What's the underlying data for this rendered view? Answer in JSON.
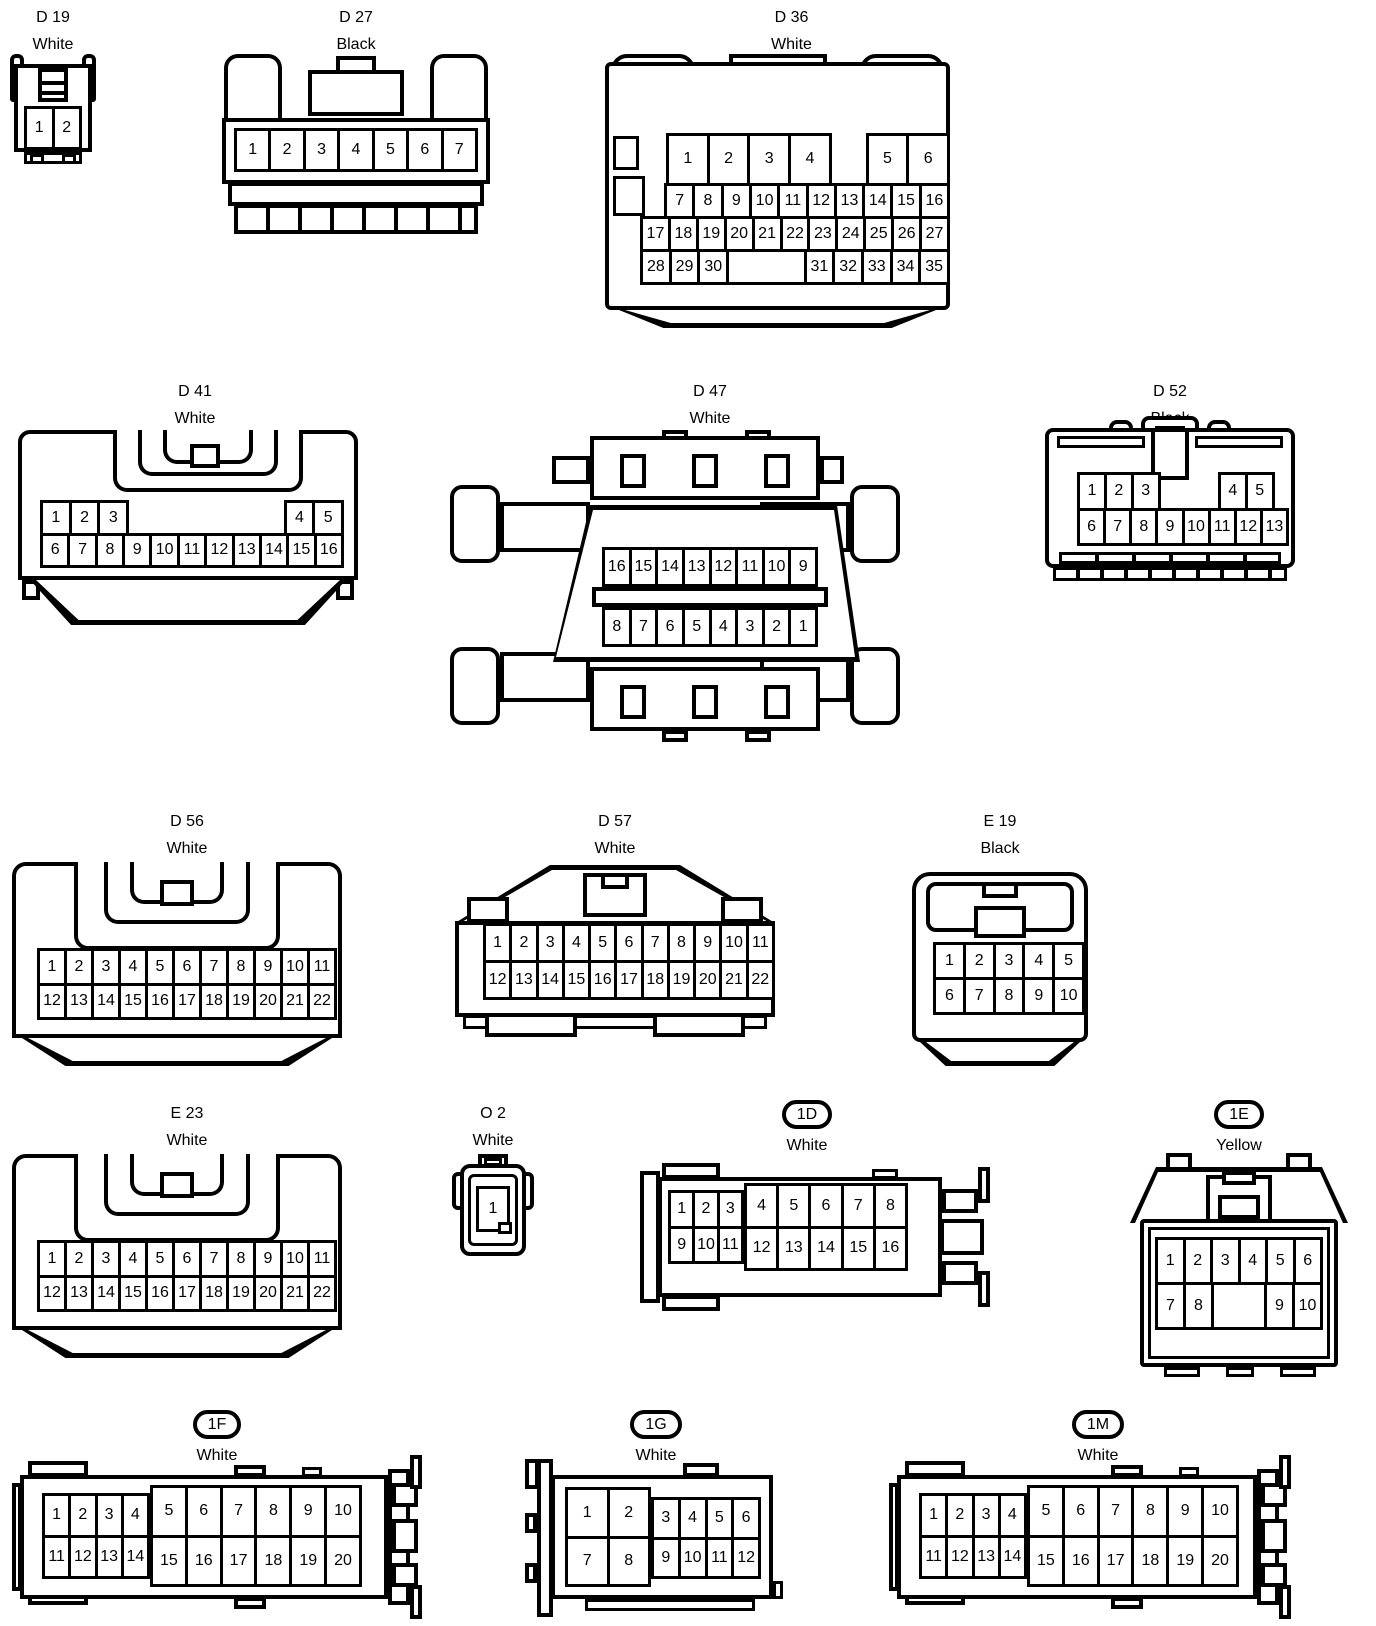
{
  "connectors": [
    {
      "id": "d19",
      "label": "D 19",
      "color": "White",
      "grids": [
        {
          "rows": [
            [
              "1",
              "2"
            ]
          ]
        }
      ]
    },
    {
      "id": "d27",
      "label": "D 27",
      "color": "Black",
      "grids": [
        {
          "rows": [
            [
              "1",
              "2",
              "3",
              "4",
              "5",
              "6",
              "7"
            ]
          ]
        }
      ]
    },
    {
      "id": "d36",
      "label": "D 36",
      "color": "White",
      "grids": [
        {
          "rows": [
            [
              {
                "g": 1
              },
              {
                "n": "1",
                "w": 1.45
              },
              {
                "n": "2",
                "w": 1.45
              },
              {
                "n": "3",
                "w": 1.45
              },
              {
                "n": "4",
                "w": 1.45
              },
              {
                "g": 1.3
              },
              {
                "n": "5",
                "w": 1.45
              },
              {
                "n": "6",
                "w": 1.45
              }
            ],
            [
              {
                "g": 0.95
              },
              "7",
              "8",
              "9",
              "10",
              "11",
              "12",
              "13",
              "14",
              "15",
              "16"
            ],
            [
              "17",
              "18",
              "19",
              "20",
              "21",
              "22",
              "23",
              "24",
              "25",
              "26",
              "27"
            ],
            [
              "28",
              "29",
              "30",
              {
                "b": 2.9
              },
              "31",
              "32",
              "33",
              "34",
              "35"
            ]
          ]
        }
      ]
    },
    {
      "id": "d41",
      "label": "D 41",
      "color": "White",
      "grids": [
        {
          "rows": [
            [
              "1",
              "2",
              "3",
              {
                "g": 6
              },
              "4",
              "5"
            ],
            [
              "6",
              "7",
              "8",
              "9",
              "10",
              "11",
              "12",
              "13",
              "14",
              "15",
              "16"
            ]
          ]
        }
      ]
    },
    {
      "id": "d47",
      "label": "D 47",
      "color": "White",
      "grids": [
        {
          "rows": [
            [
              "16",
              "15",
              "14",
              "13",
              "12",
              "11",
              "10",
              "9"
            ]
          ]
        },
        {
          "rows": [
            [
              "8",
              "7",
              "6",
              "5",
              "4",
              "3",
              "2",
              "1"
            ]
          ]
        }
      ]
    },
    {
      "id": "d52",
      "label": "D 52",
      "color": "Black",
      "grids": [
        {
          "rows": [
            [
              "1",
              "2",
              "3",
              {
                "g": 2.4
              },
              "4",
              "5",
              {
                "g": 0.6
              }
            ],
            [
              "6",
              "7",
              "8",
              "9",
              "10",
              "11",
              "12",
              "13"
            ]
          ]
        }
      ]
    },
    {
      "id": "d56",
      "label": "D 56",
      "color": "White",
      "grids": [
        {
          "rows": [
            [
              "1",
              "2",
              "3",
              "4",
              "5",
              "6",
              "7",
              "8",
              "9",
              "10",
              "11"
            ],
            [
              "12",
              "13",
              "14",
              "15",
              "16",
              "17",
              "18",
              "19",
              "20",
              "21",
              "22"
            ]
          ]
        }
      ]
    },
    {
      "id": "d57",
      "label": "D 57",
      "color": "White",
      "grids": [
        {
          "rows": [
            [
              "1",
              "2",
              "3",
              "4",
              "5",
              "6",
              "7",
              "8",
              "9",
              "10",
              "11"
            ],
            [
              "12",
              "13",
              "14",
              "15",
              "16",
              "17",
              "18",
              "19",
              "20",
              "21",
              "22"
            ]
          ]
        }
      ]
    },
    {
      "id": "e19",
      "label": "E 19",
      "color": "Black",
      "grids": [
        {
          "rows": [
            [
              "1",
              "2",
              "3",
              "4",
              "5"
            ],
            [
              "6",
              "7",
              "8",
              "9",
              "10"
            ]
          ]
        }
      ]
    },
    {
      "id": "e23",
      "label": "E 23",
      "color": "White",
      "grids": [
        {
          "rows": [
            [
              "1",
              "2",
              "3",
              "4",
              "5",
              "6",
              "7",
              "8",
              "9",
              "10",
              "11"
            ],
            [
              "12",
              "13",
              "14",
              "15",
              "16",
              "17",
              "18",
              "19",
              "20",
              "21",
              "22"
            ]
          ]
        }
      ]
    },
    {
      "id": "o2",
      "label": "O 2",
      "color": "White",
      "grids": [
        {
          "rows": [
            [
              "1"
            ]
          ]
        }
      ]
    },
    {
      "id": "1d",
      "label": "1D",
      "color": "White",
      "grids": [
        {
          "rows": [
            [
              "1",
              "2",
              "3"
            ],
            [
              "9",
              "10",
              "11"
            ]
          ]
        },
        {
          "rows": [
            [
              "4",
              "5",
              "6",
              "7",
              "8"
            ],
            [
              "12",
              "13",
              "14",
              "15",
              "16"
            ]
          ]
        }
      ]
    },
    {
      "id": "1e",
      "label": "1E",
      "color": "Yellow",
      "grids": [
        {
          "rows": [
            [
              "1",
              "2",
              "3",
              "4",
              "5",
              "6"
            ],
            [
              "7",
              "8",
              {
                "b": 2
              },
              "9",
              "10"
            ]
          ]
        }
      ]
    },
    {
      "id": "1f",
      "label": "1F",
      "color": "White",
      "grids": [
        {
          "rows": [
            [
              "1",
              "2",
              "3",
              "4"
            ],
            [
              "11",
              "12",
              "13",
              "14"
            ]
          ]
        },
        {
          "rows": [
            [
              "5",
              "6",
              "7",
              "8",
              "9",
              "10"
            ],
            [
              "15",
              "16",
              "17",
              "18",
              "19",
              "20"
            ]
          ]
        }
      ]
    },
    {
      "id": "1g",
      "label": "1G",
      "color": "White",
      "grids": [
        {
          "rows": [
            [
              "1",
              "2"
            ],
            [
              "7",
              "8"
            ]
          ]
        },
        {
          "rows": [
            [
              "3",
              "4",
              "5",
              "6"
            ],
            [
              "9",
              "10",
              "11",
              "12"
            ]
          ]
        }
      ]
    },
    {
      "id": "1m",
      "label": "1M",
      "color": "White",
      "grids": [
        {
          "rows": [
            [
              "1",
              "2",
              "3",
              "4"
            ],
            [
              "11",
              "12",
              "13",
              "14"
            ]
          ]
        },
        {
          "rows": [
            [
              "5",
              "6",
              "7",
              "8",
              "9",
              "10"
            ],
            [
              "15",
              "16",
              "17",
              "18",
              "19",
              "20"
            ]
          ]
        }
      ]
    }
  ]
}
